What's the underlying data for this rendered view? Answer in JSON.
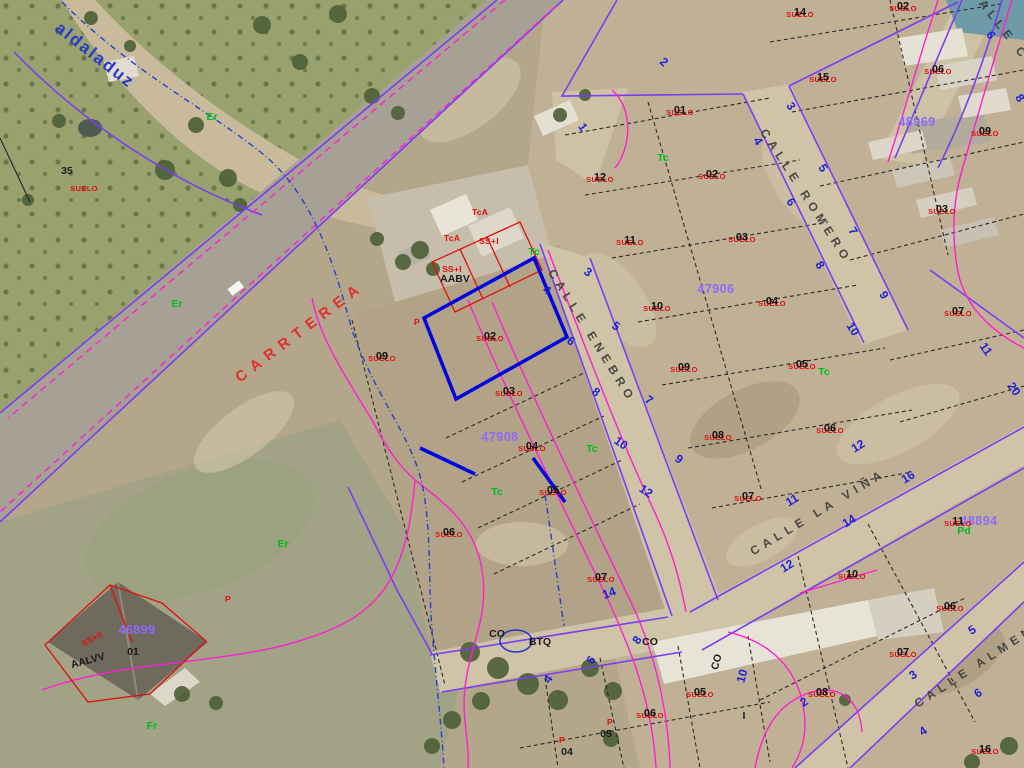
{
  "map_type": "spanish-cadastral-parcel-viewer-over-aerial-photo",
  "colors": {
    "parcel_line": "#7a3df2",
    "road_edge_line": "#ff1fd0",
    "selected_parcel": "#0000e0",
    "building_outline": "#e01010",
    "suelo_text": "#e01010",
    "parcel_number_text": "#1a1a1a",
    "block_number_text": "#8d6bfa",
    "house_number_text": "#1f1fd6",
    "land_use_code_text": "#00bb22",
    "street_text": "#3c3c3c",
    "carretera_text": "#e03030",
    "camino_text": "#2838c8"
  },
  "streets": {
    "items": [
      [
        "CARRTEREA",
        300,
        332,
        -37,
        "carretera"
      ],
      [
        "CALLE ENEBRO",
        592,
        336,
        58,
        "calle"
      ],
      [
        "CALLE ROMERO",
        806,
        196,
        57,
        "calle"
      ],
      [
        "CALLE LA VIÑA",
        818,
        512,
        -31,
        "calle"
      ],
      [
        "CALLE ALMENDRO",
        992,
        655,
        -33,
        "calle"
      ],
      [
        "CALLE CA",
        1004,
        30,
        52,
        "calle"
      ],
      [
        "aldaladuz",
        95,
        55,
        38,
        "camino"
      ]
    ]
  },
  "block_numbers": {
    "items": [
      [
        "46899",
        137,
        630
      ],
      [
        "47908",
        500,
        437
      ],
      [
        "47906",
        716,
        289
      ],
      [
        "48969",
        917,
        122
      ],
      [
        "48894",
        979,
        521
      ]
    ]
  },
  "suelo": {
    "text": "SUELO",
    "items": [
      [
        "",
        84,
        187
      ],
      [
        "09",
        382,
        357
      ],
      [
        "02",
        490,
        337
      ],
      [
        "03",
        509,
        392
      ],
      [
        "04",
        532,
        447
      ],
      [
        "05",
        553,
        491
      ],
      [
        "06",
        449,
        533
      ],
      [
        "07",
        601,
        578
      ],
      [
        "12",
        600,
        178
      ],
      [
        "11",
        630,
        241
      ],
      [
        "10",
        657,
        307
      ],
      [
        "09",
        684,
        368
      ],
      [
        "08",
        718,
        436
      ],
      [
        "07",
        748,
        497
      ],
      [
        "01",
        680,
        111
      ],
      [
        "02",
        712,
        175
      ],
      [
        "03",
        742,
        238
      ],
      [
        "04",
        772,
        302
      ],
      [
        "05",
        802,
        365
      ],
      [
        "06",
        830,
        429
      ],
      [
        "14",
        800,
        13
      ],
      [
        "15",
        823,
        78
      ],
      [
        "02",
        903,
        7
      ],
      [
        "06",
        938,
        70
      ],
      [
        "09",
        985,
        132
      ],
      [
        "03",
        942,
        210
      ],
      [
        "07",
        958,
        312
      ],
      [
        "10",
        852,
        575
      ],
      [
        "11",
        958,
        522
      ],
      [
        "06",
        950,
        607
      ],
      [
        "07",
        903,
        653
      ],
      [
        "08",
        822,
        693
      ],
      [
        "16",
        985,
        750
      ],
      [
        "06",
        650,
        714
      ],
      [
        "05",
        700,
        693
      ]
    ]
  },
  "house_numbers": {
    "items": [
      [
        "4",
        547,
        290,
        35
      ],
      [
        "6",
        571,
        341,
        35
      ],
      [
        "8",
        596,
        392,
        35
      ],
      [
        "10",
        621,
        443,
        35
      ],
      [
        "12",
        646,
        491,
        35
      ],
      [
        "14",
        609,
        593,
        -20
      ],
      [
        "3",
        588,
        272,
        35
      ],
      [
        "5",
        616,
        326,
        35
      ],
      [
        "7",
        649,
        400,
        35
      ],
      [
        "9",
        679,
        459,
        35
      ],
      [
        "4",
        758,
        141,
        57
      ],
      [
        "6",
        791,
        202,
        57
      ],
      [
        "8",
        820,
        265,
        57
      ],
      [
        "10",
        853,
        329,
        57
      ],
      [
        "3",
        791,
        106,
        57
      ],
      [
        "5",
        823,
        168,
        57
      ],
      [
        "7",
        853,
        231,
        57
      ],
      [
        "9",
        884,
        295,
        57
      ],
      [
        "2",
        664,
        62,
        40
      ],
      [
        "1",
        583,
        127,
        55
      ],
      [
        "6",
        991,
        35,
        55
      ],
      [
        "8",
        1020,
        98,
        55
      ],
      [
        "11",
        986,
        349,
        55
      ],
      [
        "20",
        1014,
        389,
        55
      ],
      [
        "12",
        858,
        446,
        -31
      ],
      [
        "11",
        792,
        500,
        -31
      ],
      [
        "14",
        849,
        521,
        -31
      ],
      [
        "16",
        908,
        477,
        -31
      ],
      [
        "12",
        787,
        566,
        -31
      ],
      [
        "5",
        972,
        630,
        -33
      ],
      [
        "3",
        913,
        675,
        -33
      ],
      [
        "6",
        978,
        693,
        -33
      ],
      [
        "4",
        923,
        731,
        -33
      ],
      [
        "2",
        804,
        702,
        -33
      ],
      [
        "4",
        548,
        679,
        -55
      ],
      [
        "6",
        591,
        660,
        -55
      ],
      [
        "8",
        637,
        640,
        -55
      ],
      [
        "10",
        742,
        676,
        -75
      ]
    ]
  },
  "green_codes": {
    "items": [
      [
        "Tc",
        534,
        252
      ],
      [
        "Tc",
        592,
        449
      ],
      [
        "Tc",
        824,
        372
      ],
      [
        "Tc",
        663,
        158
      ],
      [
        "Tc",
        497,
        492
      ],
      [
        "Er",
        212,
        117
      ],
      [
        "Er",
        177,
        304
      ],
      [
        "Er",
        283,
        544
      ],
      [
        "Fr",
        152,
        726
      ],
      [
        "Pd",
        964,
        531
      ]
    ]
  },
  "red_annotations": {
    "items": [
      [
        "SS+I",
        489,
        241,
        0
      ],
      [
        "SS+I",
        452,
        269,
        0
      ],
      [
        "SS+II",
        92,
        639,
        -28
      ],
      [
        "TcA",
        480,
        212,
        0
      ],
      [
        "TcA",
        452,
        238,
        0
      ],
      [
        "P",
        417,
        322,
        0
      ],
      [
        "P",
        228,
        599,
        0
      ],
      [
        "P",
        610,
        722,
        0
      ],
      [
        "P",
        562,
        740,
        0
      ]
    ]
  },
  "black_annotations": {
    "items": [
      [
        "AABV",
        455,
        279,
        0
      ],
      [
        "AALVV",
        88,
        661,
        -15
      ],
      [
        "01",
        133,
        652,
        0
      ],
      [
        "35",
        67,
        171,
        0
      ],
      [
        "CO",
        497,
        634,
        0
      ],
      [
        "CO",
        650,
        642,
        0
      ],
      [
        "CO",
        717,
        662,
        -75
      ],
      [
        "BTQ",
        540,
        642,
        0
      ],
      [
        "04",
        567,
        752,
        0
      ],
      [
        "05",
        606,
        734,
        0
      ],
      [
        "I",
        744,
        716,
        0
      ]
    ]
  }
}
